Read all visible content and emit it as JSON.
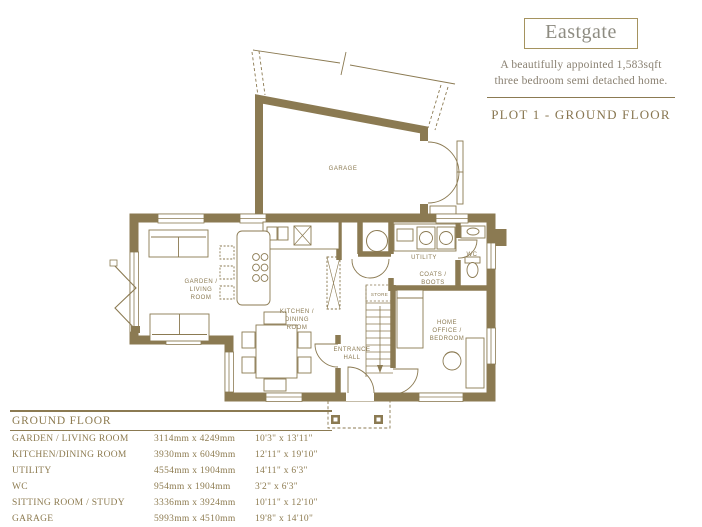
{
  "header": {
    "title": "Eastgate",
    "description_line1": "A beautifully appointed 1,583sqft",
    "description_line2": "three bedroom semi detached home.",
    "plot_label": "PLOT 1 - GROUND FLOOR"
  },
  "plan": {
    "accent_color": "#8b7a52",
    "labels": {
      "garage": "GARAGE",
      "garden": [
        "GARDEN /",
        "LIVING",
        "ROOM"
      ],
      "kitchen": [
        "KITCHEN /",
        "DINING",
        "ROOM"
      ],
      "utility": "UTILITY",
      "coats": [
        "COATS /",
        "BOOTS"
      ],
      "wc": "WC",
      "store": "STORE",
      "entrance": [
        "ENTRANCE",
        "HALL"
      ],
      "office": [
        "HOME",
        "OFFICE /",
        "BEDROOM"
      ]
    }
  },
  "table": {
    "title": "GROUND FLOOR",
    "rows": [
      {
        "name": "GARDEN / LIVING ROOM",
        "metric": "3114mm x 4249mm",
        "imperial": "10'3\" x 13'11\""
      },
      {
        "name": "KITCHEN/DINING ROOM",
        "metric": "3930mm x 6049mm",
        "imperial": "12'11\" x 19'10\""
      },
      {
        "name": "UTILITY",
        "metric": "4554mm x 1904mm",
        "imperial": "14'11\" x 6'3\""
      },
      {
        "name": "WC",
        "metric": "954mm x 1904mm",
        "imperial": "3'2\" x 6'3\""
      },
      {
        "name": "SITTING ROOM / STUDY",
        "metric": "3336mm x 3924mm",
        "imperial": "10'11\" x 12'10\""
      },
      {
        "name": "GARAGE",
        "metric": "5993mm x 4510mm",
        "imperial": "19'8\" x 14'10\""
      }
    ]
  }
}
